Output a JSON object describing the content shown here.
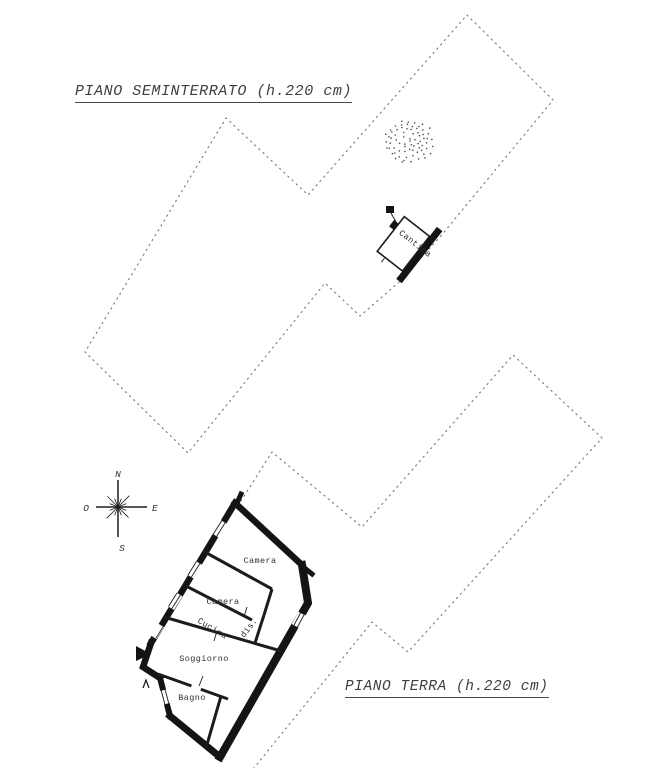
{
  "drawing": {
    "floors": {
      "seminterrato": {
        "title": "PIANO SEMINTERRATO (h.220 cm)"
      },
      "terra": {
        "title": "PIANO TERRA (h.220 cm)"
      }
    },
    "rooms": {
      "cantina": "Cantina",
      "camera1": "Camera",
      "camera2": "Camera",
      "cucina": "Cucina",
      "dis": "dis.",
      "soggiorno": "Soggiorno",
      "bagno": "Bagno"
    },
    "compass": {
      "north": "N",
      "south": "S",
      "east": "E",
      "west": "O"
    },
    "colors": {
      "ink": "#141414",
      "boundary_dots": "#7d7d7d",
      "label_text": "#2e2e2e",
      "paper": "#ffffff"
    }
  }
}
